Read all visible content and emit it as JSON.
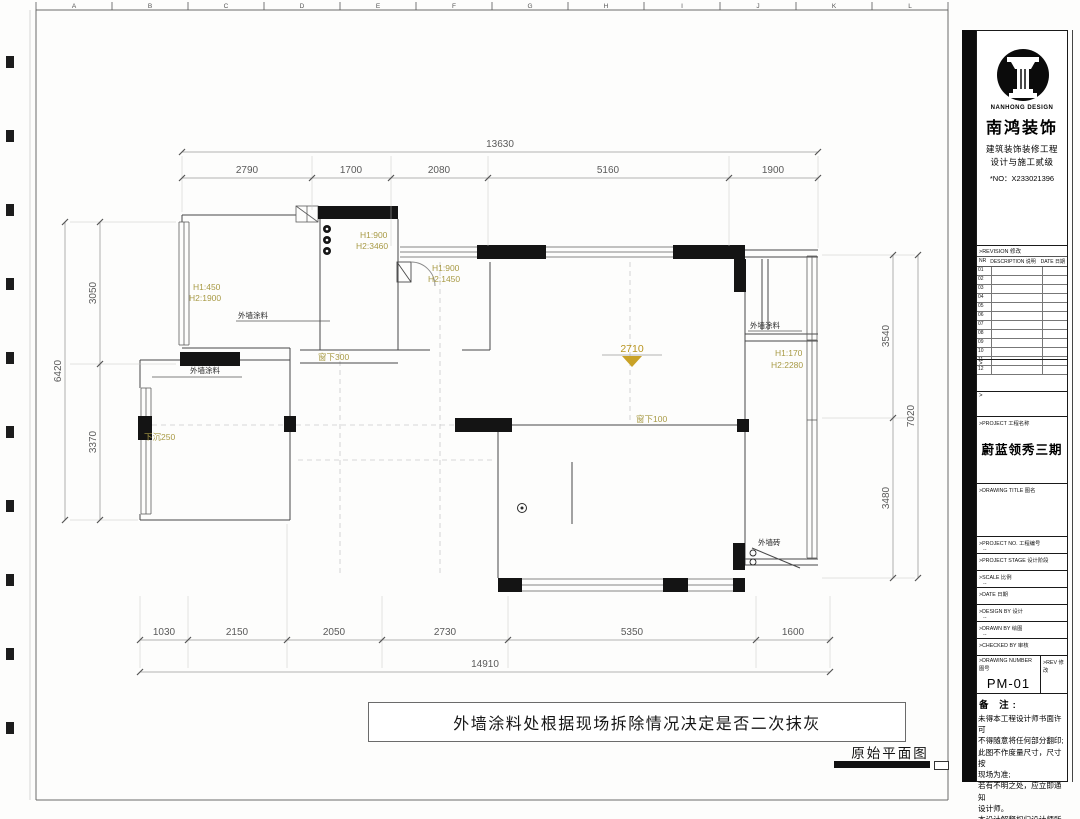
{
  "sheet": {
    "ruler_letters": [
      "A",
      "B",
      "C",
      "D",
      "E",
      "F",
      "G",
      "H",
      "I",
      "J",
      "K",
      "L"
    ]
  },
  "plan": {
    "dims": {
      "top": {
        "total": "13630",
        "segments": [
          "2790",
          "1700",
          "2080",
          "5160",
          "1900"
        ]
      },
      "bottom": {
        "total": "14910",
        "segments": [
          "1030",
          "2150",
          "2050",
          "2730",
          "5350",
          "1600"
        ]
      },
      "left": {
        "total": "6420",
        "segments": [
          "3050",
          "3370"
        ]
      },
      "right": {
        "total": "7020",
        "segments": [
          "3540",
          "3480"
        ]
      }
    },
    "annotations": {
      "win1_l1": "H1:450",
      "win1_l2": "H2:1900",
      "win2_l1": "H1:900",
      "win2_l2": "H2:3460",
      "win3_l1": "H1:900",
      "win3_l2": "H2:1450",
      "win4_l1": "H1:170",
      "win4_l2": "H2:2280",
      "ceiling_height": "2710",
      "sill_300": "窗下300",
      "sill_100": "窗下100",
      "sunken": "下沉250",
      "wall_coating": "外墙涂料",
      "wall_brick": "外墙砖"
    },
    "note": "外墙涂料处根据现场拆除情况决定是否二次抹灰",
    "caption": "原始平面图",
    "colors": {
      "annotation": "#a89a45",
      "accent": "#c9a227"
    }
  },
  "titleblock": {
    "brand": {
      "latin": "NANHONG DESIGN",
      "cn": "南鸿装饰",
      "cert1": "建筑装饰装修工程",
      "cert2": "设计与施工贰级",
      "no": "*NO：X233021396"
    },
    "revision": {
      "header": ">REVISION 修改",
      "col_no": "NR",
      "col_desc": "DESCRIPTION 说明",
      "col_date": "DATE 日期",
      "rows": [
        "01",
        "02",
        "03",
        "04",
        "05",
        "06",
        "07",
        "08",
        "09",
        "10",
        "11",
        "12"
      ]
    },
    "marker": ">",
    "fields": {
      "project_label": ">PROJECT 工程名称",
      "project_value": "蔚蓝领秀三期",
      "drawing_title_label": ">DRAWING TITLE 图名",
      "project_no_label": ">PROJECT NO. 工程编号",
      "project_stage_label": ">PROJECT STAGE 设计阶段",
      "scale_label": ">SCALE 比例",
      "date_label": ">DATE 日期",
      "design_by_label": ">DESIGN BY 设计",
      "drawn_by_label": ">DRAWN BY 绘图",
      "checked_by_label": ">CHECKED BY 审核",
      "drawing_number_label": ">DRAWING NUMBER 图号",
      "rev_label": ">REV 修改",
      "drawing_number_value": "PM-01",
      "dash": "--"
    },
    "remarks": {
      "title": "备 注:",
      "lines": [
        "未得本工程设计师书面许可",
        "不得随意将任何部分翻印;",
        "此图不作度量尺寸，尺寸按",
        "现场为准;",
        "若有不明之处，应立即通知",
        "设计师。",
        "本设计解释权归设计师所有"
      ]
    }
  }
}
